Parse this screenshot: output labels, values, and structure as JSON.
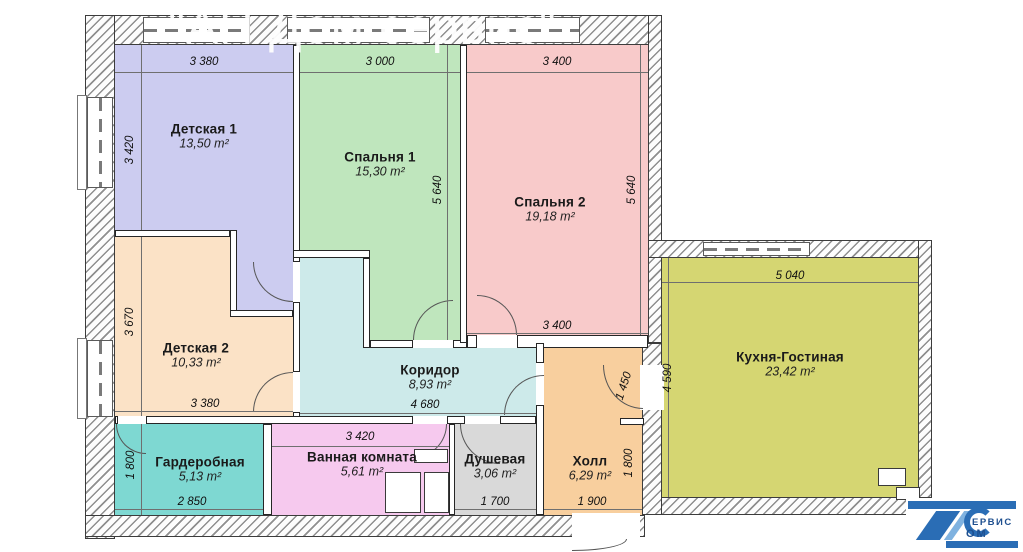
{
  "watermark": "\"АН Дом сервис\"",
  "rooms": [
    {
      "id": "detskaya1",
      "name": "Детская 1",
      "area": "13,50 m²",
      "color": "#ccccf0"
    },
    {
      "id": "spalnya1",
      "name": "Спальня 1",
      "area": "15,30 m²",
      "color": "#bfe6bd"
    },
    {
      "id": "spalnya2",
      "name": "Спальня 2",
      "area": "19,18 m²",
      "color": "#f8caca"
    },
    {
      "id": "detskaya2",
      "name": "Детская 2",
      "area": "10,33 m²",
      "color": "#fbe2c6"
    },
    {
      "id": "koridor",
      "name": "Коридор",
      "area": "8,93 m²",
      "color": "#cdeaea"
    },
    {
      "id": "kuhnya",
      "name": "Кухня-Гостиная",
      "area": "23,42 m²",
      "color": "#d5d672"
    },
    {
      "id": "garderobnaya",
      "name": "Гардеробная",
      "area": "5,13 m²",
      "color": "#7ed8d2"
    },
    {
      "id": "vannaya",
      "name": "Ванная комната",
      "area": "5,61 m²",
      "color": "#f6c9ee"
    },
    {
      "id": "dushevaya",
      "name": "Душевая",
      "area": "3,06 m²",
      "color": "#d9d9d9"
    },
    {
      "id": "holl",
      "name": "Холл",
      "area": "6,29 m²",
      "color": "#f8cf9e"
    }
  ],
  "dimensions": {
    "detskaya1_top": "3 380",
    "spalnya1_top": "3 000",
    "spalnya2_top": "3 400",
    "detskaya1_left": "3 420",
    "detskaya2_left": "3 670",
    "garderob_left": "1 800",
    "spalnya1_right": "5 640",
    "spalnya2_right": "5 640",
    "spalnya2_bottom": "3 400",
    "corridor_bottom": "4 680",
    "detskaya2_bottom": "3 380",
    "vannaya_top": "3 420",
    "garderob_bottom": "2 850",
    "dush_bottom": "1 700",
    "hall_bottom": "1 900",
    "hall_right": "1 800",
    "hall_upper": "1 450",
    "kitchen_left": "4 590",
    "kitchen_top": "5 040"
  },
  "logo": {
    "line1": "ЕРВИС",
    "line2": "ОМ"
  },
  "palette": {
    "wall_line": "#3c3c3c",
    "dim_text": "#101010",
    "watermark_color": "#ffffff",
    "logo_blue": "#2a6db5"
  }
}
